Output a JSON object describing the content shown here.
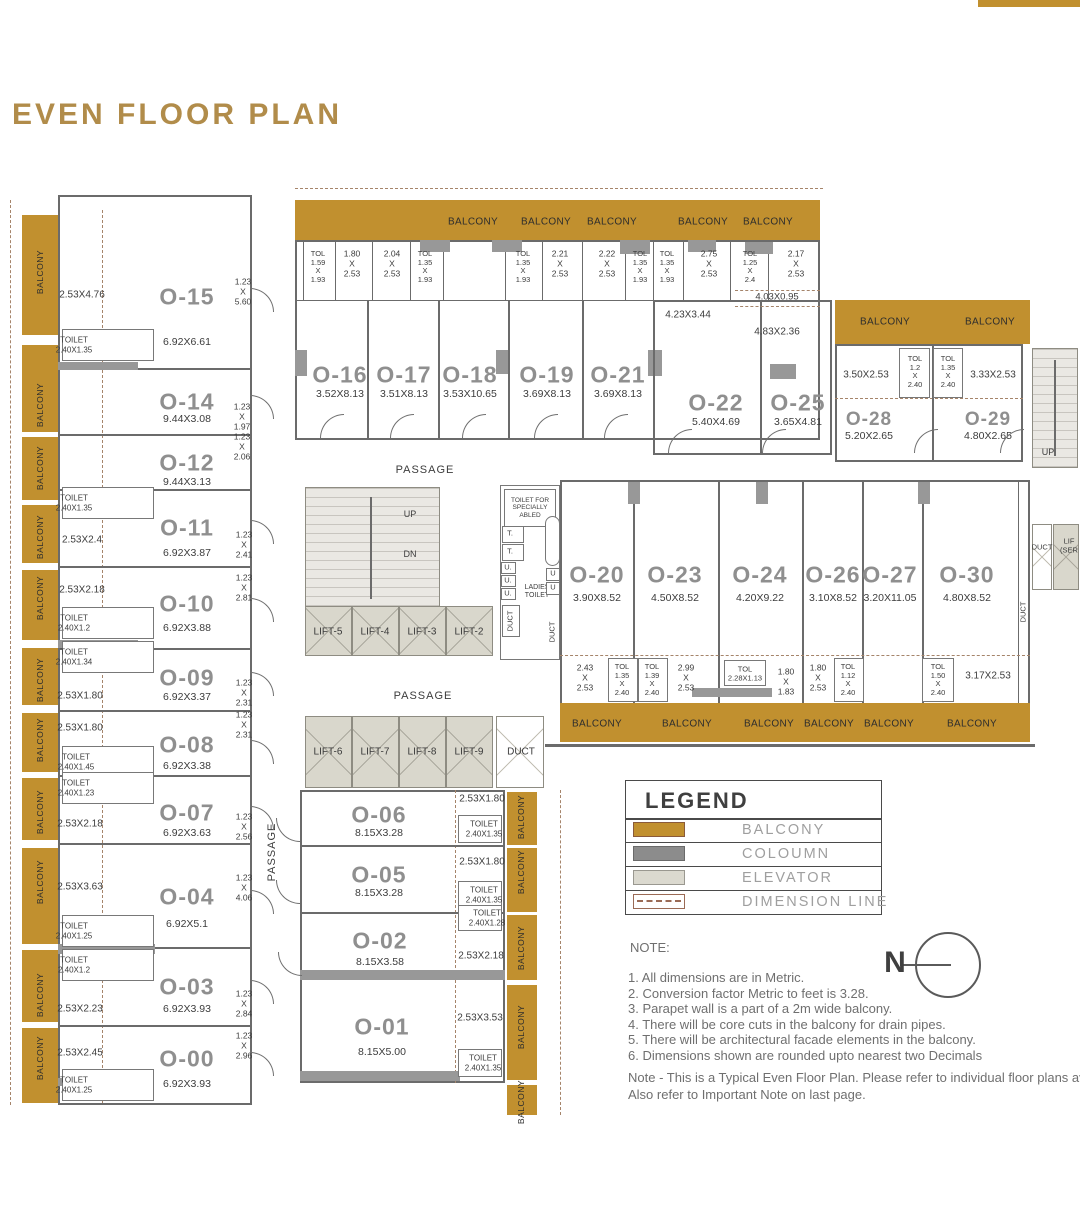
{
  "title": "EVEN FLOOR PLAN",
  "labels": {
    "balcony": "BALCONY",
    "passage": "PASSAGE",
    "up": "UP",
    "dn": "DN",
    "duct": "DUCT",
    "ladies_toilet": "LADIES\nTOILET",
    "specially_abled": "TOILET FOR\nSPECIALLY\nABLED",
    "t": "T.",
    "u_dot": "U.",
    "u": "U",
    "lift_service": "LIF\n(SER",
    "north": "N"
  },
  "lifts": {
    "l2": "LIFT-2",
    "l3": "LIFT-3",
    "l4": "LIFT-4",
    "l5": "LIFT-5",
    "l6": "LIFT-6",
    "l7": "LIFT-7",
    "l8": "LIFT-8",
    "l9": "LIFT-9"
  },
  "units": {
    "o00": {
      "id": "O-00",
      "dim": "6.92X3.93"
    },
    "o01": {
      "id": "O-01",
      "dim": "8.15X5.00"
    },
    "o02": {
      "id": "O-02",
      "dim": "8.15X3.58"
    },
    "o03": {
      "id": "O-03",
      "dim": "6.92X3.93"
    },
    "o04": {
      "id": "O-04",
      "dim": "6.92X5.1"
    },
    "o05": {
      "id": "O-05",
      "dim": "8.15X3.28"
    },
    "o06": {
      "id": "O-06",
      "dim": "8.15X3.28"
    },
    "o07": {
      "id": "O-07",
      "dim": "6.92X3.63"
    },
    "o08": {
      "id": "O-08",
      "dim": "6.92X3.38"
    },
    "o09": {
      "id": "O-09",
      "dim": "6.92X3.37"
    },
    "o10": {
      "id": "O-10",
      "dim": "6.92X3.88"
    },
    "o11": {
      "id": "O-11",
      "dim": "6.92X3.87"
    },
    "o12": {
      "id": "O-12",
      "dim": "9.44X3.13"
    },
    "o14": {
      "id": "O-14",
      "dim": "9.44X3.08"
    },
    "o15": {
      "id": "O-15",
      "dim": "6.92X6.61"
    },
    "o16": {
      "id": "O-16",
      "dim": "3.52X8.13"
    },
    "o17": {
      "id": "O-17",
      "dim": "3.51X8.13"
    },
    "o18": {
      "id": "O-18",
      "dim": "3.53X10.65"
    },
    "o19": {
      "id": "O-19",
      "dim": "3.69X8.13"
    },
    "o21": {
      "id": "O-21",
      "dim": "3.69X8.13"
    },
    "o22": {
      "id": "O-22",
      "dim": "5.40X4.69"
    },
    "o25": {
      "id": "O-25",
      "dim": "3.65X4.81"
    },
    "o28": {
      "id": "O-28",
      "dim": "5.20X2.65"
    },
    "o29": {
      "id": "O-29",
      "dim": "4.80X2.65"
    },
    "o20": {
      "id": "O-20",
      "dim": "3.90X8.52"
    },
    "o23": {
      "id": "O-23",
      "dim": "4.50X8.52"
    },
    "o24": {
      "id": "O-24",
      "dim": "4.20X9.22"
    },
    "o26": {
      "id": "O-26",
      "dim": "3.10X8.52"
    },
    "o27": {
      "id": "O-27",
      "dim": "3.20X11.05"
    },
    "o30": {
      "id": "O-30",
      "dim": "4.80X8.52"
    }
  },
  "annot": {
    "l15_bal": "2.53X4.76",
    "l15_tol": "TOILET\n2.40X1.35",
    "l15_side": "1.23\nX\n5.60",
    "l14_side": "1.23\nX\n1.97",
    "l12_side": "1.23\nX\n2.06",
    "l11_tol": "TOILET\n2.40X1.35",
    "l11_bal": "2.53X2.4",
    "l11_side": "1.23\nX\n2.41",
    "l10_bal": "2.53X2.18",
    "l10_tol": "TOILET\n2.40X1.2",
    "l10_side": "1.23\nX\n2.81",
    "l09_tol": "TOILET\n2.40X1.34",
    "l09_bal": "2.53X1.80",
    "l09_side": "1.23\nX\n2.31",
    "l08_bal": "2.53X1.80",
    "l08_tol": "TOILET\n2.40X1.45",
    "l08_side": "1.23\nX\n2.31",
    "l07_tol": "TOILET\n2.40X1.23",
    "l07_bal": "2.53X2.18",
    "l07_side": "1.23\nX\n2.56",
    "l04_bal": "2.53X3.63",
    "l04_tol": "TOILET\n2.40X1.25",
    "l04_side": "1.23\nX\n4.06",
    "l03_tol": "TOILET\n2.40X1.2",
    "l03_bal": "2.53X2.23",
    "l03_side": "1.23\nX\n2.84",
    "l00_bal": "2.53X2.45",
    "l00_tol": "TOILET\n2.40X1.25",
    "l00_side": "1.23\nX\n2.96",
    "ts1": "TOL\n1.59\nX\n1.93",
    "ts2": "1.80\nX\n2.53",
    "ts3": "2.04\nX\n2.53",
    "ts4": "TOL\n1.35\nX\n1.93",
    "ts5": "TOL\n1.35\nX\n1.93",
    "ts6": "2.21\nX\n2.53",
    "ts7": "2.22\nX\n2.53",
    "ts8": "TOL\n1.35\nX\n1.93",
    "ts9": "TOL\n1.35\nX\n1.93",
    "ts10": "2.75\nX\n2.53",
    "ts11": "TOL\n1.25\nX\n2.4",
    "ts12": "2.17\nX\n2.53",
    "mid_403": "4.03X0.95",
    "mid_423": "4.23X3.44",
    "mid_483": "4.83X2.36",
    "r28_a": "3.50X2.53",
    "r28_tol": "TOL\n1.2\nX\n2.40",
    "r29_tol": "TOL\n1.35\nX\n2.40",
    "r29_a": "3.33X2.53",
    "rb1": "2.43\nX\n2.53",
    "rb2": "TOL\n1.35\nX\n2.40",
    "rb3": "TOL\n1.39\nX\n2.40",
    "rb4": "2.99\nX\n2.53",
    "rb5": "TOL\n2.28X1.13",
    "rb6": "1.80\nX\n1.83",
    "rb7": "1.80\nX\n2.53",
    "rb8": "TOL\n1.12\nX\n2.40",
    "rb9": "TOL\n1.50\nX\n2.40",
    "rb10": "3.17X2.53",
    "b06_bal": "2.53X1.80",
    "b06_tol": "TOILET\n2.40X1.35",
    "b05_bal": "2.53X1.80",
    "b05_tol": "TOILET\n2.40X1.35",
    "b02_tol": "TOILET\n2.40X1.28",
    "b02_bal": "2.53X2.18",
    "b01_bal": "2.53X3.53",
    "b01_tol": "TOILET\n2.40X1.35"
  },
  "legend": {
    "title": "LEGEND",
    "rows": [
      {
        "label": "BALCONY"
      },
      {
        "label": "COLOUMN"
      },
      {
        "label": "ELEVATOR"
      },
      {
        "label": "DIMENSION LINE"
      }
    ]
  },
  "notes": {
    "heading": "NOTE:",
    "items": [
      "1.  All dimensions are in Metric.",
      "2. Conversion factor Metric to feet is 3.28.",
      "3. Parapet wall is a part of a 2m wide balcony.",
      "4. There will be core cuts in the balcony for drain pipes.",
      "5. There will be architectural facade elements in the balcony.",
      "6. Dimensions shown are rounded upto nearest two Decimals"
    ],
    "footer1": "Note - This is a Typical Even Floor Plan. Please refer to individual floor plans ava",
    "footer2": "Also refer to Important Note on last page."
  },
  "colors": {
    "balcony": "#c1902f",
    "column": "#8c8c8c",
    "elevator": "#d9d7cc",
    "title": "#b18c4a"
  }
}
